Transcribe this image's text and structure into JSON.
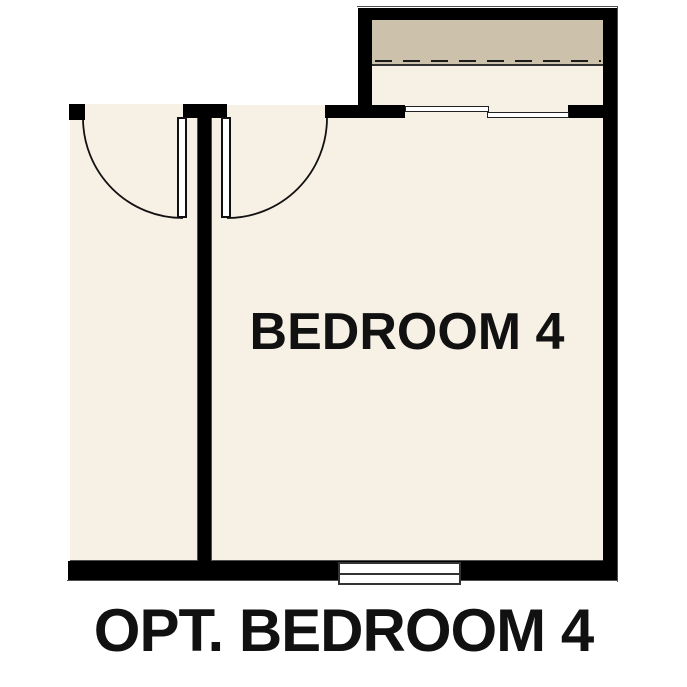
{
  "plan": {
    "room_label": "BEDROOM 4",
    "caption": "OPT. BEDROOM 4"
  },
  "colors": {
    "floor": "#f7f0e4",
    "shelf": "#ccc1ab",
    "wall": "#000000",
    "outline": "#4f4f4f",
    "label": "#111111",
    "background": "#ffffff"
  }
}
